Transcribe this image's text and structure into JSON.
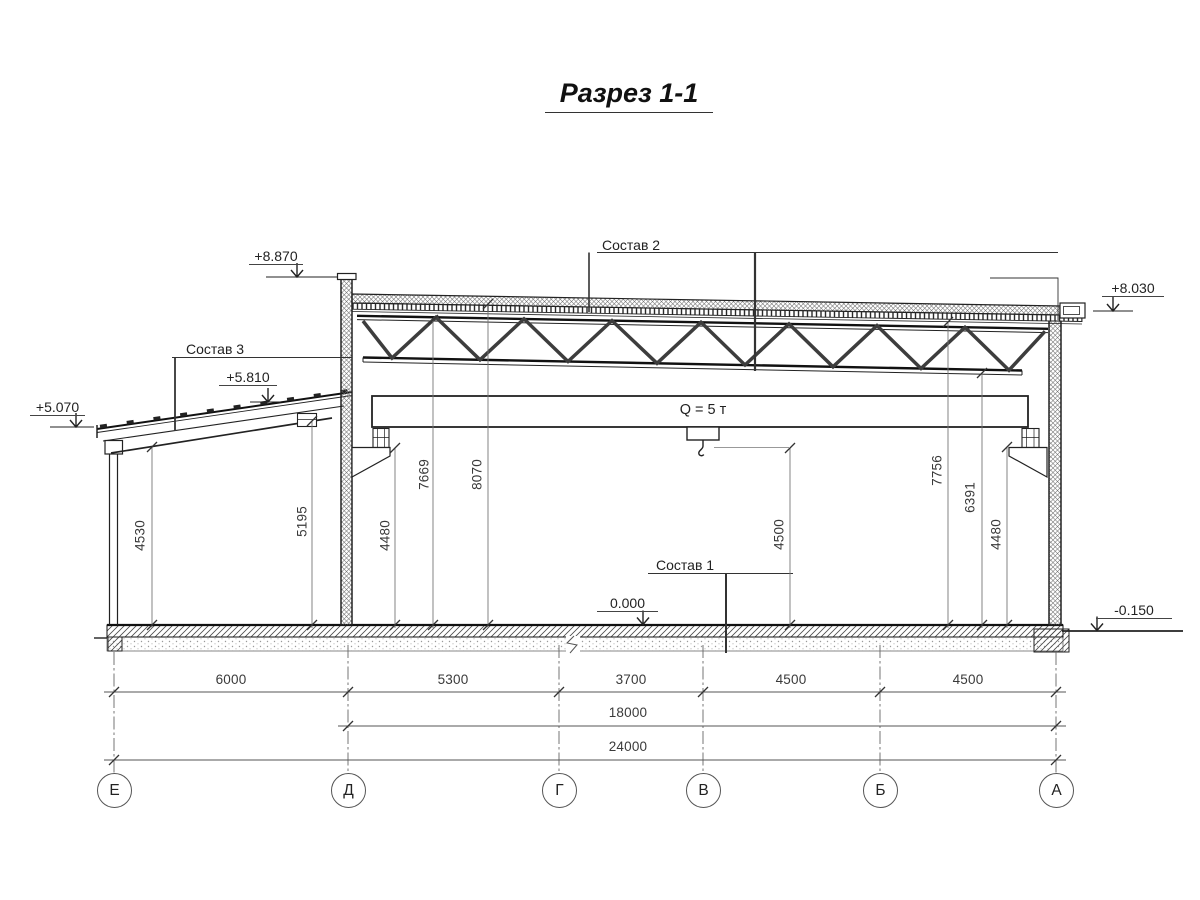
{
  "title": "Разрез 1-1",
  "callouts": {
    "sostav_1": "Состав 1",
    "sostav_2": "Состав 2",
    "sostav_3": "Состав 3"
  },
  "crane_label": "Q = 5 т",
  "elevations": {
    "parapet_left": "+8.870",
    "roof_edge_right": "+8.030",
    "annex_high": "+5.810",
    "annex_low": "+5.070",
    "floor_zero": "0.000",
    "ground_right": "-0.150"
  },
  "vdims": [
    "4530",
    "5195",
    "4480",
    "7669",
    "8070",
    "4500",
    "7756",
    "6391",
    "4480"
  ],
  "spans": [
    "6000",
    "5300",
    "3700",
    "4500",
    "4500"
  ],
  "totals": {
    "bay": "18000",
    "overall": "24000"
  },
  "axes": [
    "Е",
    "Д",
    "Г",
    "В",
    "Б",
    "А"
  ]
}
